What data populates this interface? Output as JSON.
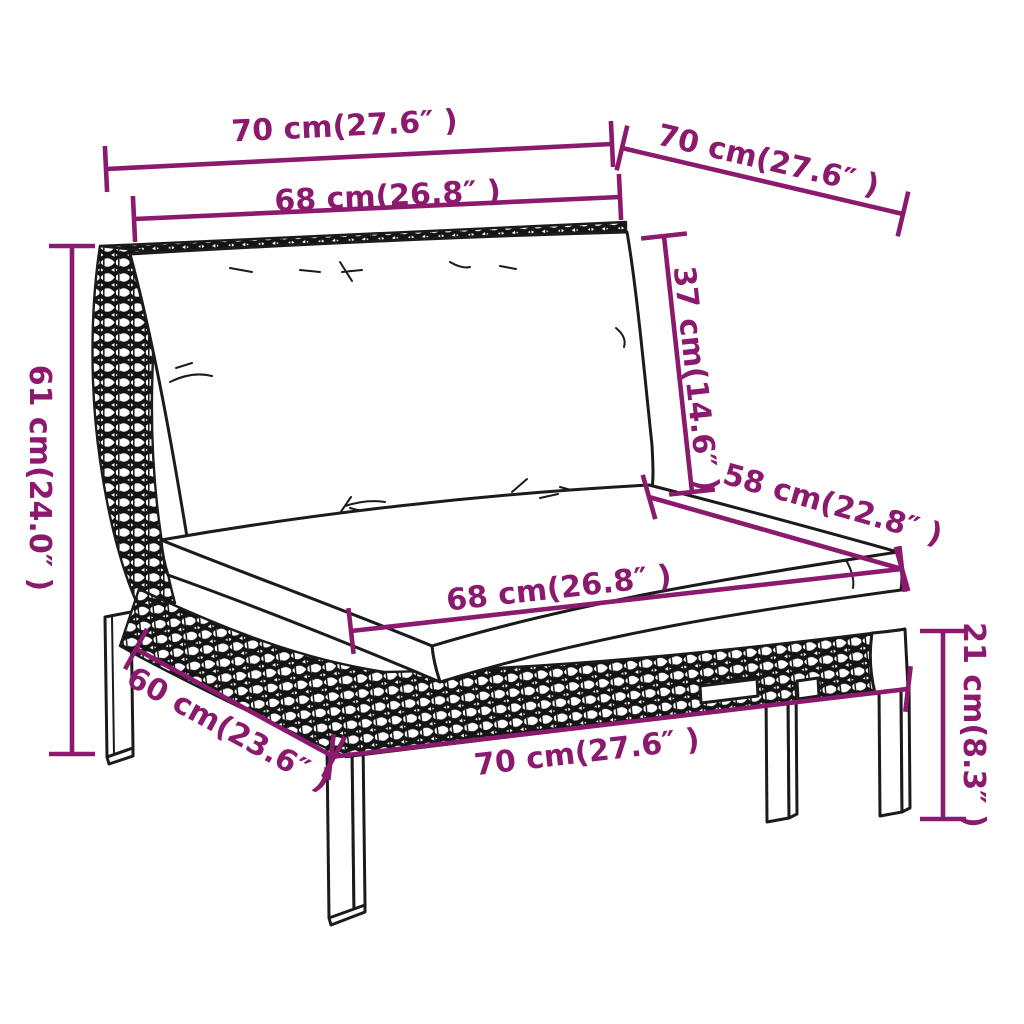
{
  "diagram": {
    "type": "furniture-dimension-diagram",
    "colors": {
      "dimension_accent": "#8B1A6E",
      "drawing_line": "#1b1b1b",
      "background": "#ffffff"
    },
    "dimensions": {
      "top_width": "70 cm(27.6″ )",
      "top_depth": "70 cm(27.6″ )",
      "back_cushion_width": "68 cm(26.8″ )",
      "back_cushion_height": "37 cm(14.6″ )",
      "total_height": "61 cm(24.0″ )",
      "seat_depth": "58 cm(22.8″ )",
      "seat_cushion_width": "68 cm(26.8″ )",
      "base_depth": "60 cm(23.6″ )",
      "base_width": "70 cm(27.6″ )",
      "leg_height": "21 cm(8.3″ )"
    }
  }
}
